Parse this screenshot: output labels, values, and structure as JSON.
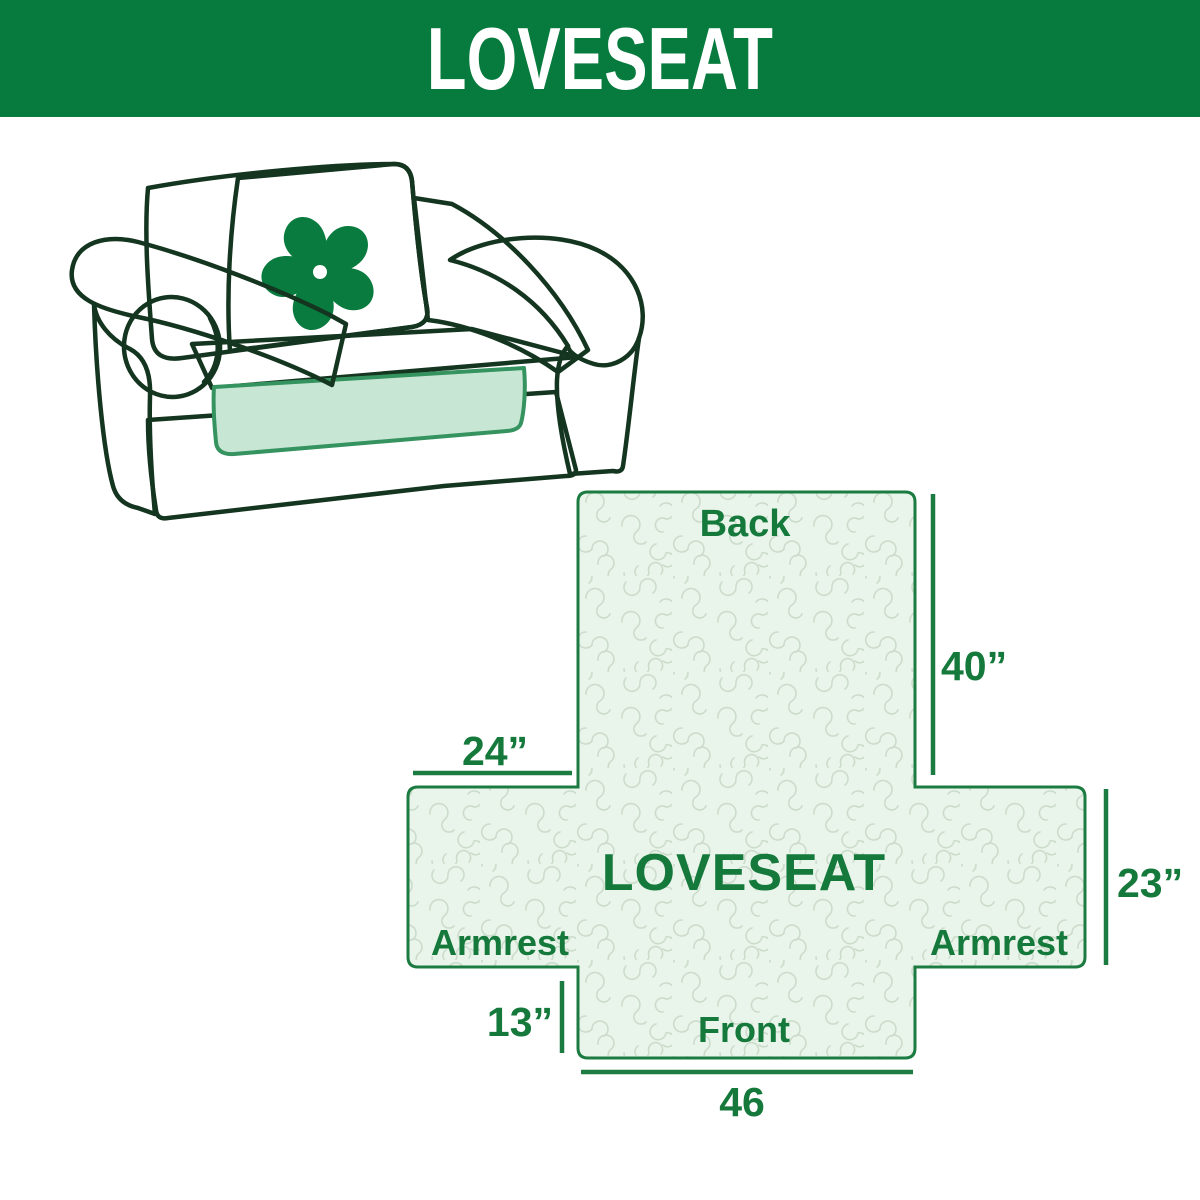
{
  "banner": {
    "title": "LOVESEAT",
    "bg_color": "#077a3d",
    "text_color": "#ffffff"
  },
  "illustration": {
    "description": "Line drawing of a two-seat loveseat sofa fitted with a mint green protective cover",
    "logo_icon": "pinwheel-icon",
    "logo_color": "#0a7b3e",
    "cover_color": "#c8e6d4",
    "outline_color": "#14351f"
  },
  "diagram": {
    "center_label": "LOVESEAT",
    "back_label": "Back",
    "front_label": "Front",
    "armrest_left_label": "Armrest",
    "armrest_right_label": "Armrest",
    "dimensions": {
      "back_height": "40”",
      "armrest_top_width": "24”",
      "armrest_side_height": "23”",
      "front_skirt_height": "13”",
      "front_width": "46"
    },
    "fill_color": "#e9f5ea",
    "pattern_color": "#ccdccc",
    "line_color": "#1c7b40",
    "text_color": "#15793c"
  }
}
